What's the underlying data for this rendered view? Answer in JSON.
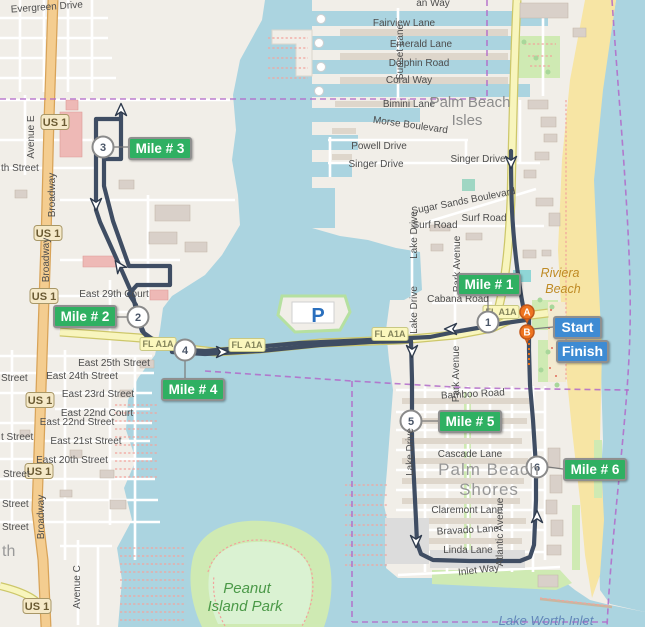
{
  "colors": {
    "route": "#3f4d63",
    "badge_green": "#2fb062",
    "badge_blue": "#3e8bd3",
    "badge_border": "#8f8f8f",
    "boundary": "#b168c9",
    "water": "#abd4e0",
    "land": "#f1eee8",
    "sand": "#f7e5a4",
    "pin_orange": "#ee7420",
    "park_green": "#cfeab3",
    "road_primary": "#f4cd90",
    "road_secondary": "#f8f5bd",
    "building": "#d9d0c9",
    "shield_fill": "#f5e9c8"
  },
  "markers": {
    "mile_numbers": [
      "1",
      "2",
      "3",
      "4",
      "5",
      "6"
    ],
    "mile_labels": [
      "Mile # 1",
      "Mile # 2",
      "Mile # 3",
      "Mile # 4",
      "Mile # 5",
      "Mile # 6"
    ],
    "start": "Start",
    "finish": "Finish",
    "pin_a": "A",
    "pin_b": "B",
    "parking": "P"
  },
  "shields": {
    "us1": "US 1",
    "fl_a1a": "FL A1A"
  },
  "place_labels": {
    "palm_beach_isles_1": "Palm Beach",
    "palm_beach_isles_2": "Isles",
    "palm_beach_shores_1": "Palm Beach",
    "palm_beach_shores_2": "Shores",
    "riviera_1": "Riviera",
    "riviera_2": "Beach",
    "peanut_1": "Peanut",
    "peanut_2": "Island Park",
    "lake_worth_inlet": "Lake Worth Inlet",
    "partial_th": "th"
  },
  "streets": {
    "evergreen_drive": "Evergreen Drive",
    "top_partial": "an Way",
    "fairview_lane": "Fairview Lane",
    "emerald_lane": "Emerald Lane",
    "dolphin_road": "Dolphin Road",
    "coral_way": "Coral Way",
    "sunset_lane": "Sunset Lane",
    "bimini_lane": "Bimini Lane",
    "morse_boulevard": "Morse Boulevard",
    "powell_drive": "Powell Drive",
    "singer_drive": "Singer Drive",
    "sugar_sands_boulevard": "Sugar Sands Boulevard",
    "surf_road": "Surf Road",
    "cabana_road": "Cabana Road",
    "lake_drive": "Lake Drive",
    "park_avenue": "Park Avenue",
    "bamboo_road": "Bamboo Road",
    "cascade_lane": "Cascade Lane",
    "claremont_lane": "Claremont Lane",
    "bravado_lane": "Bravado Lane",
    "linda_lane": "Linda Lane",
    "inlet_way": "Inlet Way",
    "atlantic_avenue": "Atlantic Avenue",
    "broadway": "Broadway",
    "avenue_e": "Avenue E",
    "avenue_c": "Avenue C",
    "east_29th_court": "East 29th Court",
    "east_25th_street": "East 25th Street",
    "east_24th_street": "East 24th Street",
    "east_23rd_street": "East 23rd Street",
    "east_22nd_court": "East 22nd Court",
    "east_22nd_street": "East 22nd Street",
    "east_21st_street": "East 21st Street",
    "east_20th_street": "East 20th Street",
    "partial_street": "Street",
    "partial_t_street": "t Street",
    "partial_th_street": "th Street",
    "partial_et": "et"
  }
}
